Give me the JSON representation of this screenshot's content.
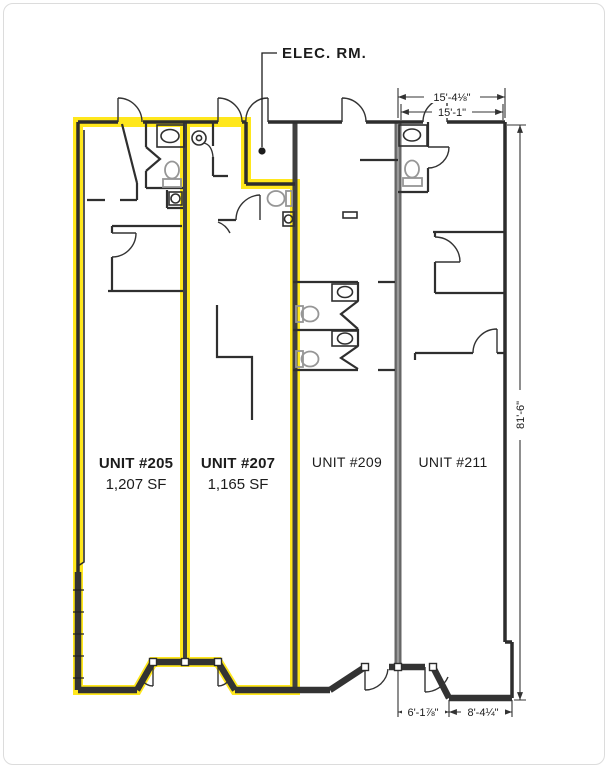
{
  "plan": {
    "elec_label": "ELEC. RM.",
    "units": [
      {
        "name": "UNIT #205",
        "area": "1,207 SF"
      },
      {
        "name": "UNIT #207",
        "area": "1,165 SF"
      },
      {
        "name": "UNIT #209"
      },
      {
        "name": "UNIT #211"
      }
    ],
    "dimensions": {
      "top_outer": "15'-4⅛\"",
      "top_inner": "15'-1\"",
      "right_side": "81'-6\"",
      "bottom_left": "6'-1⅞\"",
      "bottom_right": "8'-4¼\""
    },
    "colors": {
      "highlight_yellow": "#FFE71C",
      "wall_dark": "#2d2d2d",
      "demising_gray": "#666666",
      "fixture_gray": "#969696"
    }
  }
}
